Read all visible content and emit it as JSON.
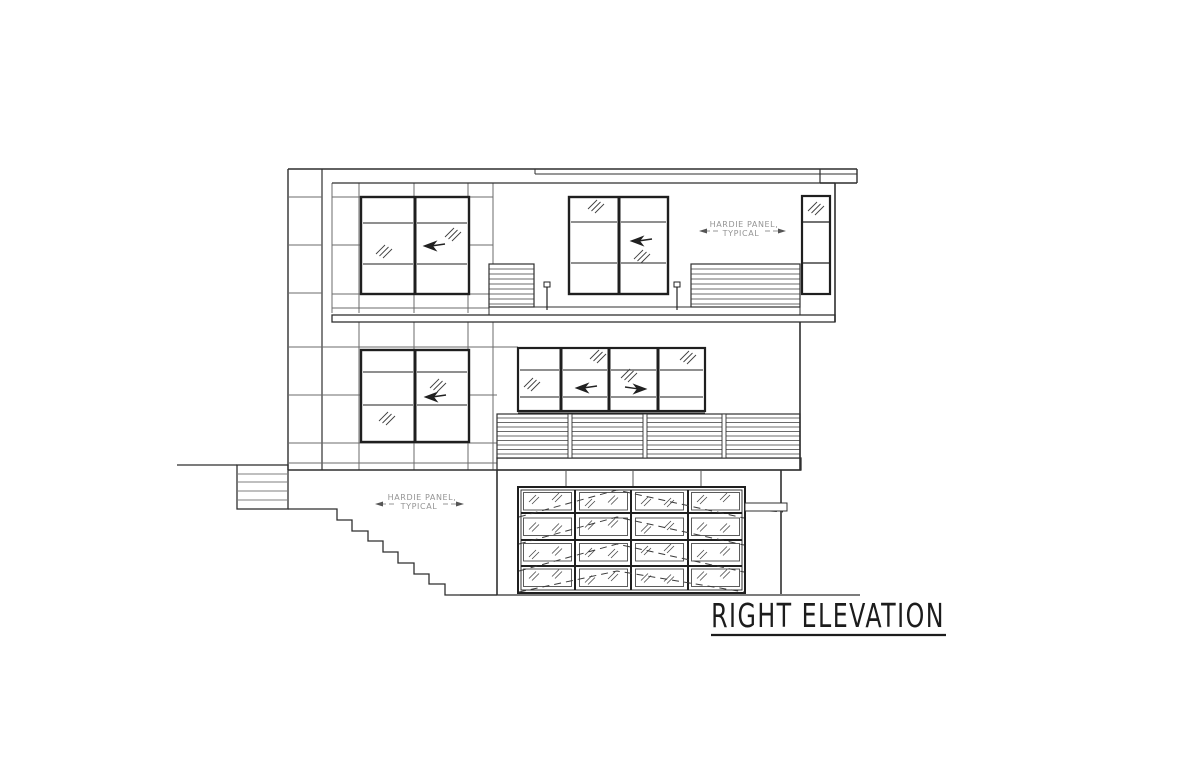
{
  "page": {
    "background": "#ffffff"
  },
  "drawing": {
    "title": "RIGHT ELEVATION",
    "annotations": {
      "upper_panel_note": {
        "line1": "HARDIE PANEL,",
        "line2": "TYPICAL"
      },
      "lower_panel_note": {
        "line1": "HARDIE PANEL,",
        "line2": "TYPICAL"
      }
    },
    "colors": {
      "line": "#2f2f2f",
      "panel_joint": "#6b6b6b",
      "note_text": "#949494",
      "title_text": "#1c1c1c"
    }
  }
}
